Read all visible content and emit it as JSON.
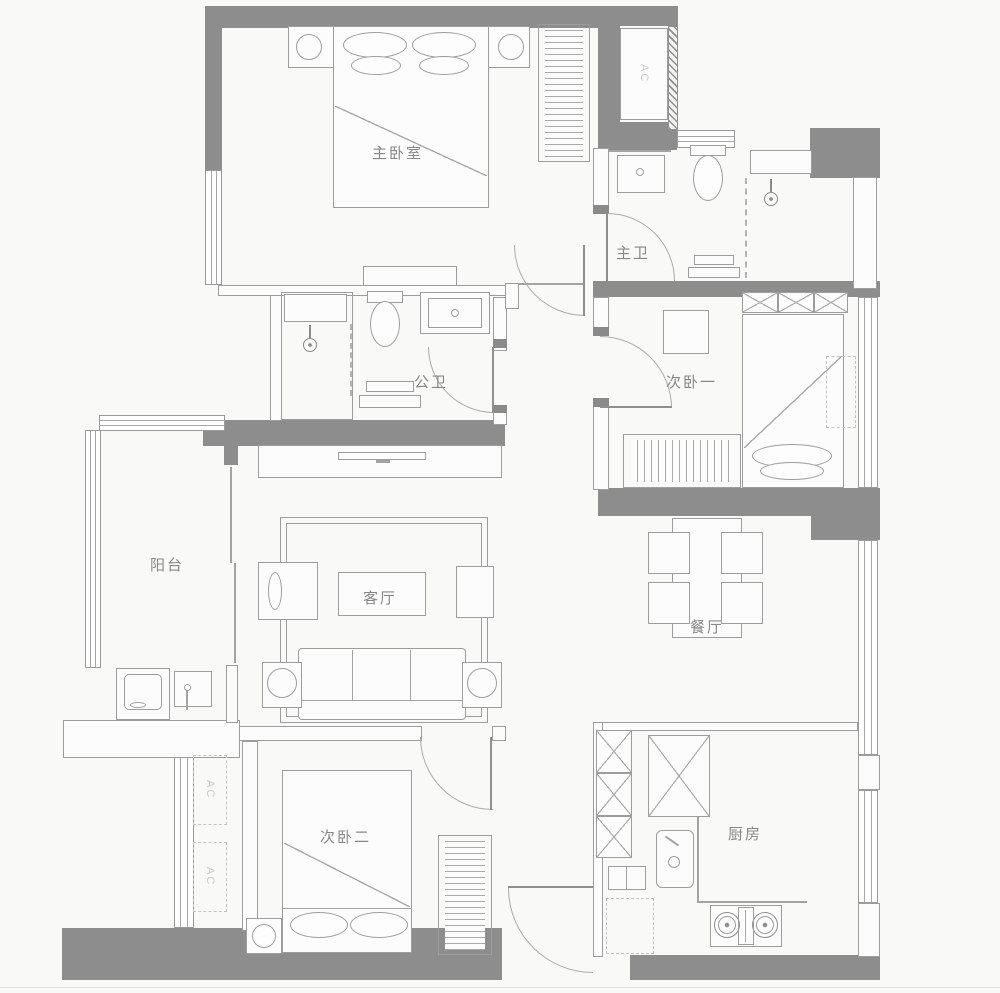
{
  "colors": {
    "wall_fill": "#8d8d8d",
    "furniture_line": "#9d9d9d",
    "background": "#f9f9f8",
    "room_label_text": "#878787",
    "ac_faint_text": "#c9c9c9"
  },
  "rooms": {
    "master_bedroom": {
      "label": "主卧室"
    },
    "master_bathroom": {
      "label": "主卫"
    },
    "guest_bathroom": {
      "label": "公卫"
    },
    "second_bedroom_one": {
      "label": "次卧一"
    },
    "balcony": {
      "label": "阳台"
    },
    "living_room": {
      "label": "客厅"
    },
    "dining_room": {
      "label": "餐厅"
    },
    "second_bedroom_two": {
      "label": "次卧二"
    },
    "kitchen": {
      "label": "厨房"
    }
  },
  "ac": {
    "top_right": "AC",
    "left_upper": "AC",
    "left_lower": "AC"
  }
}
